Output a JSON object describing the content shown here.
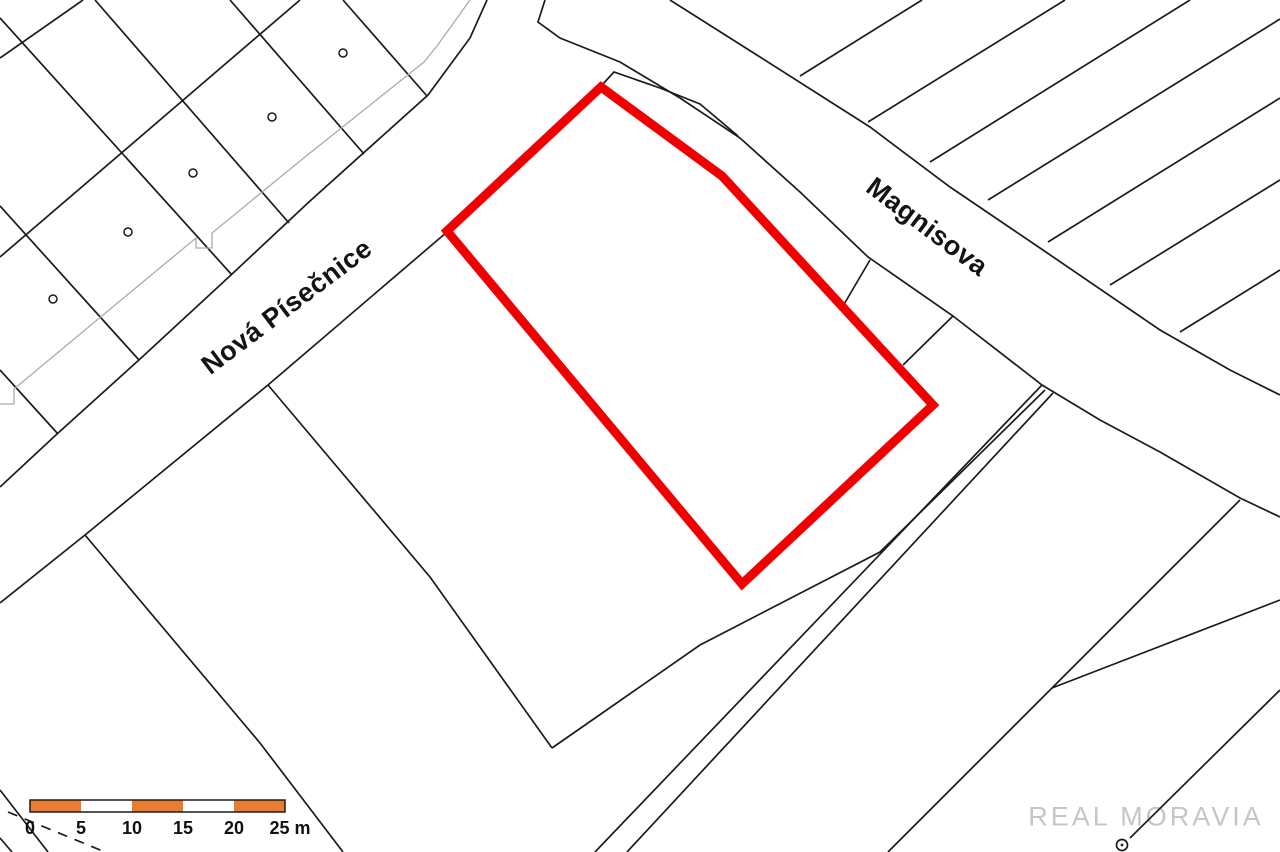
{
  "page": {
    "background": "#ffffff"
  },
  "streets": [
    {
      "name": "Nová Písečnice",
      "x": 287,
      "y": 307,
      "rotation": -37,
      "font_size": 27
    },
    {
      "name": "Magnisova",
      "x": 927,
      "y": 227,
      "rotation": 37,
      "font_size": 27
    }
  ],
  "watermark": {
    "text": "REAL MORAVIA",
    "x": 1146,
    "y": 817,
    "color": "#c6c6c6",
    "font_size": 27
  },
  "scale_bar": {
    "x": 30,
    "y": 800,
    "height": 12,
    "segment_width": 51,
    "segment_colors": [
      "#E87C30",
      "#ffffff",
      "#E87C30",
      "#ffffff",
      "#E87C30"
    ],
    "border_color": "#1b1b1b",
    "labels": [
      {
        "text": "0",
        "x": 30
      },
      {
        "text": "5",
        "x": 81
      },
      {
        "text": "10",
        "x": 132
      },
      {
        "text": "15",
        "x": 183
      },
      {
        "text": "20",
        "x": 234
      },
      {
        "text": "25 m",
        "x": 290
      }
    ],
    "label_y": 834,
    "font_size": 18
  },
  "highlighted_parcel": {
    "color": "#f00000",
    "stroke_width": 9,
    "points": [
      [
        601,
        87
      ],
      [
        722,
        176
      ],
      [
        933,
        405
      ],
      [
        742,
        584
      ],
      [
        447,
        231
      ]
    ]
  },
  "map_geometry": {
    "line_color": "#1b1b1b",
    "line_width": 1.7,
    "black_lines": [
      [
        [
          0,
          487
        ],
        [
          57,
          434
        ],
        [
          140,
          359
        ],
        [
          231,
          275
        ],
        [
          310,
          201
        ],
        [
          428,
          95
        ],
        [
          470,
          38
        ],
        [
          487,
          0
        ]
      ],
      [
        [
          545,
          0
        ],
        [
          538,
          22
        ],
        [
          560,
          38
        ],
        [
          620,
          62
        ],
        [
          680,
          98
        ],
        [
          740,
          138
        ],
        [
          800,
          192
        ],
        [
          868,
          257
        ],
        [
          953,
          316
        ],
        [
          1042,
          385
        ],
        [
          1100,
          420
        ],
        [
          1160,
          452
        ],
        [
          1240,
          498
        ],
        [
          1280,
          517
        ]
      ],
      [
        [
          601,
          86
        ],
        [
          614,
          72
        ],
        [
          660,
          88
        ],
        [
          700,
          104
        ],
        [
          738,
          136
        ]
      ],
      [
        [
          0,
          603
        ],
        [
          85,
          535
        ],
        [
          268,
          385
        ],
        [
          447,
          232
        ]
      ],
      [
        [
          95,
          0
        ],
        [
          289,
          223
        ]
      ],
      [
        [
          230,
          0
        ],
        [
          364,
          154
        ]
      ],
      [
        [
          343,
          0
        ],
        [
          427,
          96
        ]
      ],
      [
        [
          0,
          18
        ],
        [
          232,
          275
        ]
      ],
      [
        [
          0,
          206
        ],
        [
          139,
          360
        ]
      ],
      [
        [
          0,
          370
        ],
        [
          58,
          434
        ]
      ],
      [
        [
          0,
          58
        ],
        [
          83,
          0
        ]
      ],
      [
        [
          0,
          257
        ],
        [
          300,
          0
        ]
      ],
      [
        [
          85,
          535
        ],
        [
          260,
          743
        ],
        [
          343,
          852
        ]
      ],
      [
        [
          268,
          385
        ],
        [
          430,
          577
        ],
        [
          552,
          748
        ]
      ],
      [
        [
          552,
          748
        ],
        [
          700,
          645
        ],
        [
          880,
          552
        ],
        [
          1045,
          390
        ]
      ],
      [
        [
          870,
          260
        ],
        [
          843,
          306
        ]
      ],
      [
        [
          953,
          316
        ],
        [
          903,
          365
        ]
      ],
      [
        [
          1042,
          385
        ],
        [
          595,
          852
        ]
      ],
      [
        [
          1053,
          393
        ],
        [
          627,
          852
        ]
      ],
      [
        [
          1240,
          500
        ],
        [
          1052,
          688
        ],
        [
          888,
          852
        ]
      ],
      [
        [
          1052,
          688
        ],
        [
          1280,
          600
        ]
      ],
      [
        [
          1130,
          838
        ],
        [
          1280,
          690
        ]
      ],
      [
        [
          670,
          0
        ],
        [
          760,
          57
        ],
        [
          870,
          127
        ],
        [
          950,
          187
        ],
        [
          1040,
          248
        ],
        [
          1160,
          330
        ],
        [
          1230,
          370
        ],
        [
          1280,
          395
        ]
      ],
      [
        [
          800,
          76
        ],
        [
          922,
          0
        ]
      ],
      [
        [
          868,
          122
        ],
        [
          1065,
          0
        ]
      ],
      [
        [
          930,
          162
        ],
        [
          1190,
          0
        ]
      ],
      [
        [
          988,
          200
        ],
        [
          1280,
          19
        ]
      ],
      [
        [
          1048,
          242
        ],
        [
          1280,
          98
        ]
      ],
      [
        [
          1110,
          285
        ],
        [
          1280,
          180
        ]
      ],
      [
        [
          1180,
          332
        ],
        [
          1280,
          270
        ]
      ],
      [
        [
          0,
          790
        ],
        [
          48,
          852
        ]
      ],
      [
        [
          0,
          838
        ],
        [
          12,
          852
        ]
      ]
    ],
    "gray_lines": {
      "color": "#ababab",
      "width": 1.3,
      "lines": [
        [
          [
            0,
            404
          ],
          [
            14,
            404
          ],
          [
            14,
            389
          ],
          [
            97,
            320
          ],
          [
            196,
            238
          ],
          [
            196,
            248
          ],
          [
            212,
            248
          ],
          [
            212,
            233
          ],
          [
            300,
            161
          ],
          [
            424,
            62
          ],
          [
            437,
            46
          ],
          [
            470,
            0
          ]
        ]
      ]
    },
    "dashed_lines": {
      "dash": "10 8",
      "lines": [
        [
          [
            8,
            812
          ],
          [
            105,
            852
          ]
        ]
      ]
    },
    "point_circles": {
      "stroke": "#1b1b1b",
      "fill": "#ffffff",
      "r": 4,
      "centers": [
        [
          343,
          53
        ],
        [
          272,
          117
        ],
        [
          193,
          173
        ],
        [
          128,
          232
        ],
        [
          53,
          299
        ]
      ]
    },
    "target_circle": {
      "cx": 1122,
      "cy": 845,
      "r": 5.5,
      "dot_r": 1.4
    }
  }
}
